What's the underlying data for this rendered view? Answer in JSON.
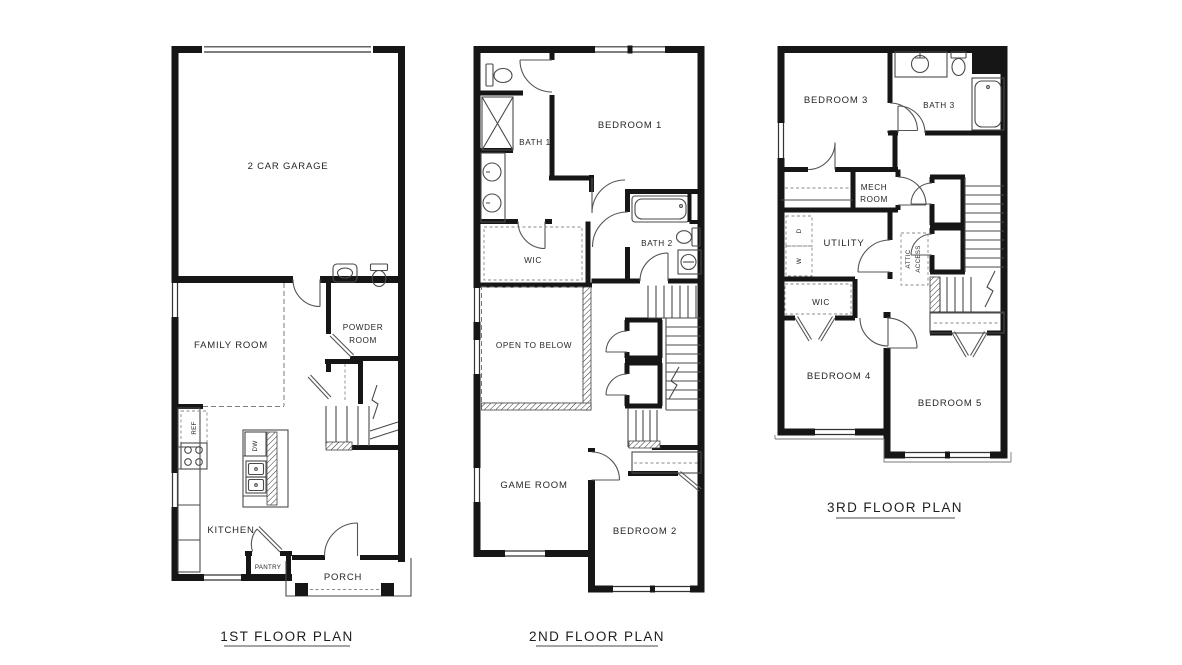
{
  "canvas": {
    "background": "#ffffff",
    "ink": "#161616"
  },
  "plans": {
    "first": {
      "title": "1ST FLOOR PLAN",
      "garage": "2 CAR GARAGE",
      "family_room": "FAMILY ROOM",
      "powder_line1": "POWDER",
      "powder_line2": "ROOM",
      "kitchen": "KITCHEN",
      "pantry": "PANTRY",
      "porch": "PORCH",
      "fridge": "REF",
      "dishwasher": "DW"
    },
    "second": {
      "title": "2ND FLOOR PLAN",
      "bath1": "BATH 1",
      "bedroom1": "BEDROOM 1",
      "wic": "WIC",
      "bath2": "BATH 2",
      "open_to_below": "OPEN TO BELOW",
      "game_room": "GAME ROOM",
      "bedroom2": "BEDROOM 2"
    },
    "third": {
      "title": "3RD FLOOR PLAN",
      "bedroom3": "BEDROOM 3",
      "bath3": "BATH 3",
      "mech_line1": "MECH",
      "mech_line2": "ROOM",
      "utility": "UTILITY",
      "attic_line1": "ATTIC",
      "attic_line2": "ACCESS",
      "wic": "WIC",
      "bedroom4": "BEDROOM 4",
      "bedroom5": "BEDROOM 5",
      "washer": "W",
      "dryer": "D"
    }
  }
}
